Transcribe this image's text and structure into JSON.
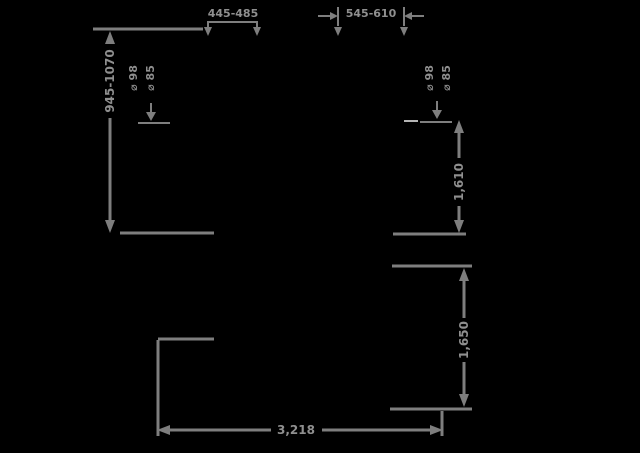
{
  "diagram": {
    "background": "#000000",
    "line_color": "#7e7e7e",
    "text_color": "#8f8f8f",
    "labels": {
      "top_left_width": "445-485",
      "top_right_width": "545-610",
      "left_height_range": "945-1070",
      "left_detail_upper": "⌀ 98",
      "left_detail_lower": "⌀ 85",
      "right_detail_upper": "⌀ 98",
      "right_detail_lower": "⌀ 85",
      "right_upper_height": "1,610",
      "right_lower_height": "1,650",
      "bottom_length": "3,218"
    }
  }
}
